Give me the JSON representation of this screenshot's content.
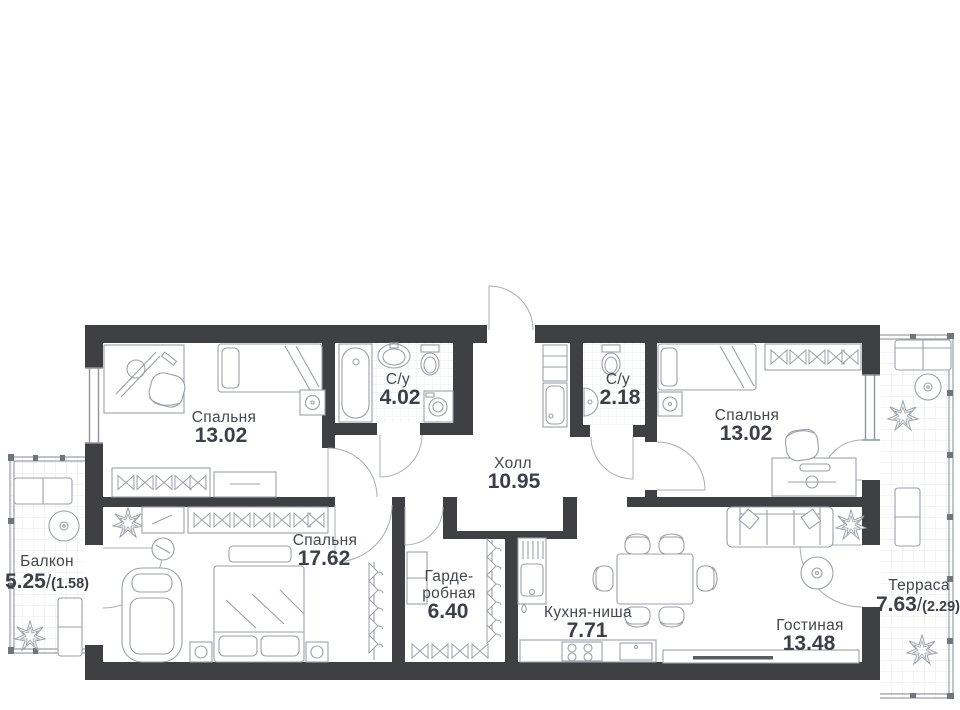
{
  "plan_type": "apartment-floor-plan",
  "rooms": {
    "bedroom_left": {
      "name": "Спальня",
      "area": "13.02"
    },
    "bathroom_main": {
      "name": "С/у",
      "area": "4.02"
    },
    "hall": {
      "name": "Холл",
      "area": "10.95"
    },
    "bathroom_guest": {
      "name": "С/у",
      "area": "2.18"
    },
    "bedroom_right": {
      "name": "Спальня",
      "area": "13.02"
    },
    "balcony": {
      "name": "Балкон",
      "area": "5.25",
      "slash": "/",
      "area_reduced": "(1.58)"
    },
    "bedroom_master": {
      "name": "Спальня",
      "area": "17.62"
    },
    "wardrobe": {
      "name_l1": "Гарде-",
      "name_l2": "робная",
      "area": "6.40"
    },
    "kitchen": {
      "name": "Кухня-ниша",
      "area": "7.71"
    },
    "living": {
      "name": "Гостиная",
      "area": "13.48"
    },
    "terrace": {
      "name": "Терраса",
      "area": "7.63",
      "slash": "/",
      "area_reduced": "(2.29)"
    }
  },
  "colors": {
    "wall": "#3f4043",
    "furniture_line": "#9aa1a9",
    "text": "#42464e",
    "tile_line": "#e7e9ec",
    "background": "#ffffff"
  }
}
